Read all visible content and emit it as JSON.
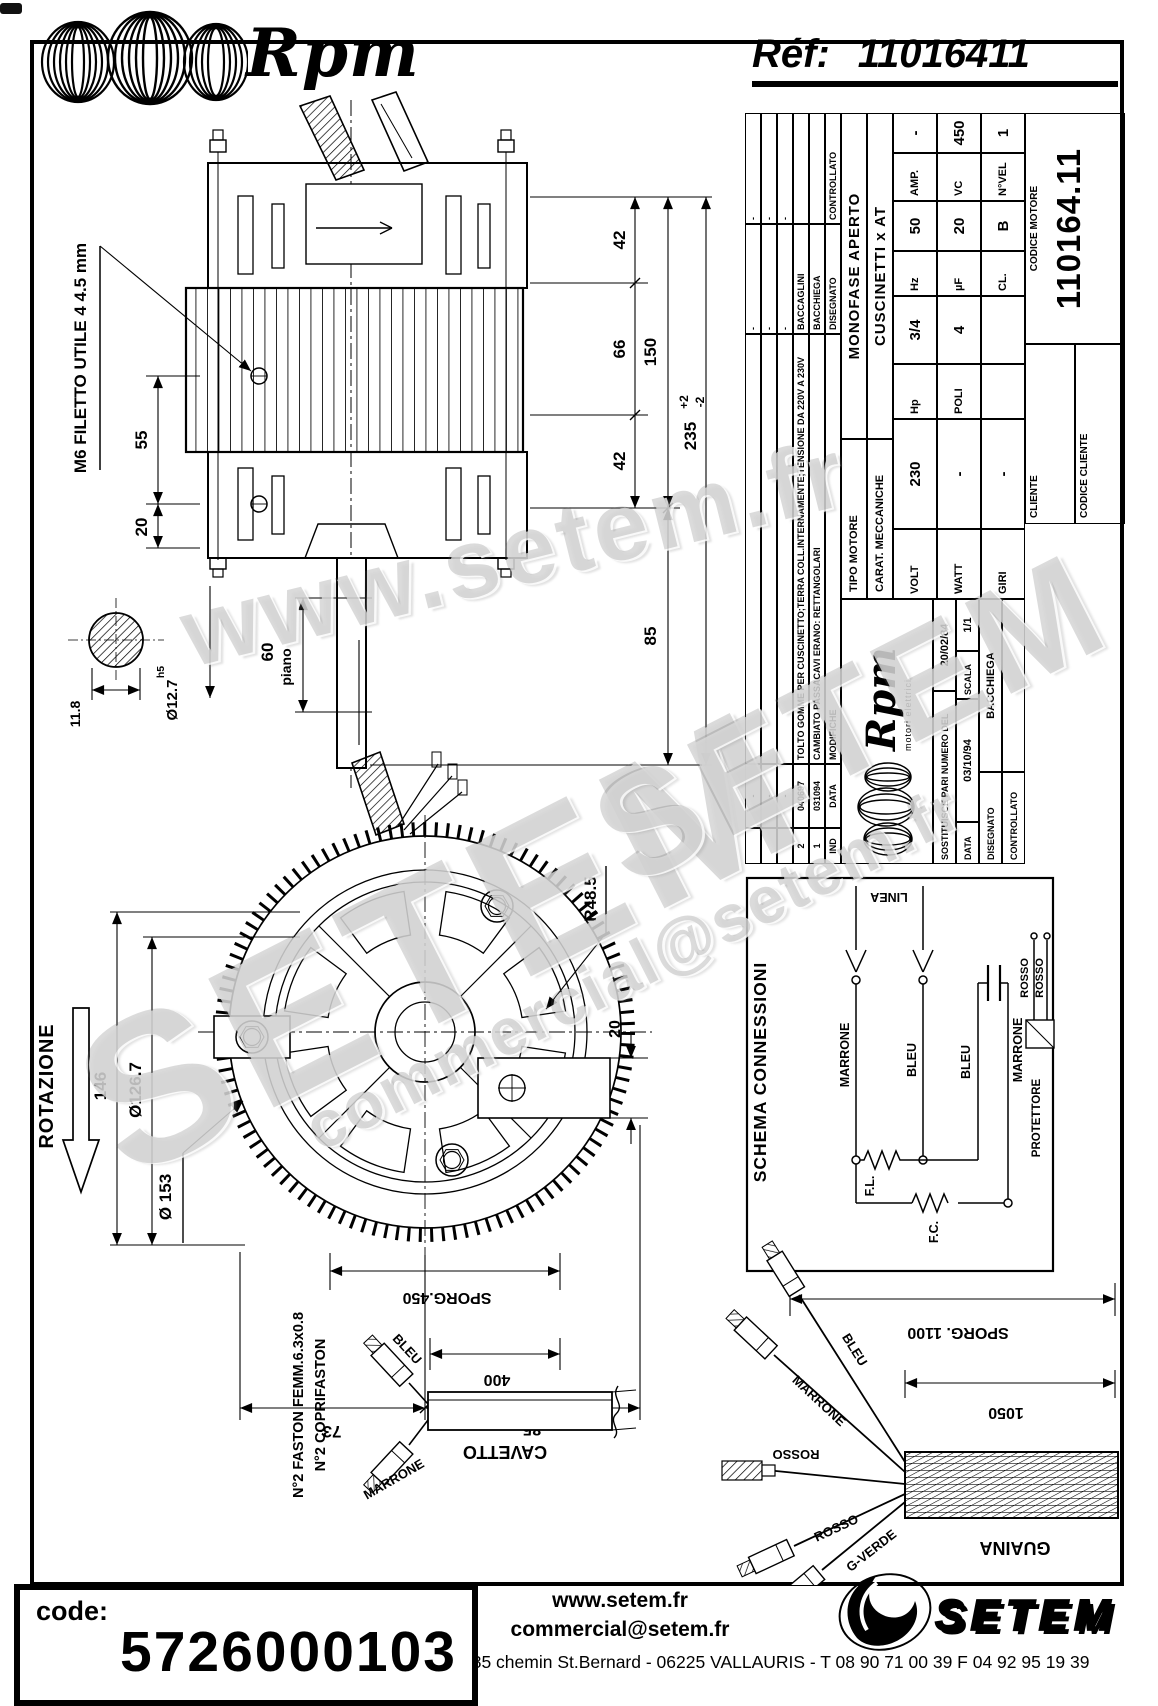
{
  "header": {
    "brand": "Rpm",
    "ref_label": "Réf:",
    "ref_value": "11016411"
  },
  "watermarks": {
    "w1": "www.setem.fr",
    "w2": "SETEM",
    "w3": "SETEM",
    "w4": "commercial@setem.fr"
  },
  "side_view": {
    "callout_m6": "M6 FILETTO UTILE 4  4.5 mm",
    "dim_55": "55",
    "dim_20": "20",
    "dim_42_top": "42",
    "dim_66": "66",
    "dim_42_bot": "42",
    "dim_150": "150",
    "dim_235": "235",
    "tol_plus": "+2",
    "tol_minus": "-2",
    "dim_85": "85",
    "dim_60": "60",
    "label_piano": "piano",
    "dim_11_8": "11.8",
    "dim_shaft": "Ø12.7",
    "fit_h5": "h5"
  },
  "front_view": {
    "label_rotazione": "ROTAZIONE",
    "dim_146": "146",
    "dim_126_7": "Ø126.7",
    "dim_153": "Ø 153",
    "dim_r48_5": "R48.5",
    "dim_20": "20",
    "dim_73": "73",
    "dim_85": "85"
  },
  "title_block": {
    "revisions": {
      "header": {
        "ind": "IND",
        "data": "DATA",
        "modifiche": "MODIFICHE",
        "disegnato": "DISEGNATO",
        "controllato": "CONTROLLATO"
      },
      "rows": [
        {
          "ind": "",
          "data": "-",
          "modifiche": "",
          "disegnato": "-",
          "controllato": "-"
        },
        {
          "ind": "",
          "data": "-",
          "modifiche": "",
          "disegnato": "-",
          "controllato": "-"
        },
        {
          "ind": "",
          "data": "-",
          "modifiche": "",
          "disegnato": "-",
          "controllato": "-"
        },
        {
          "ind": "2",
          "data": "040697",
          "modifiche": "TOLTO GOMME PER CUSCINETTO;TERRA COLL.INTERNAMENTE;TENSIONE DA 220V A 230V",
          "disegnato": "BACCAGLINI",
          "controllato": ""
        },
        {
          "ind": "1",
          "data": "031094",
          "modifiche": "CAMBIATO PASSACAVI ERANO: RETTANGOLARI",
          "disegnato": "BACCHIEGA",
          "controllato": ""
        }
      ]
    },
    "logo": {
      "brand": "Rpm",
      "tagline": "motori elettrici"
    },
    "sostituisce_label": "SOSTITUISCE PARI NUMERO DEL",
    "sostituisce_value": "20/02/84",
    "data_label": "DATA",
    "data_value": "03/10/94",
    "scala_label": "SCALA",
    "scala_value": "1/1",
    "disegnato_label": "DISEGNATO",
    "disegnato_value": "BACCHIEGA",
    "controllato_label": "CONTROLLATO",
    "controllato_value": "",
    "tipo_label": "TIPO MOTORE",
    "tipo_value": "MONOFASE APERTO",
    "carat_label": "CARAT. MECCANICHE",
    "carat_value": "CUSCINETTI x AT",
    "specs": [
      {
        "l1": "VOLT",
        "v1": "230",
        "l2": "Hp",
        "v2": "3/4",
        "l3": "Hz",
        "v3": "50",
        "l4": "AMP.",
        "v4": "-"
      },
      {
        "l1": "WATT",
        "v1": "-",
        "l2": "POLI",
        "v2": "4",
        "l3": "µF",
        "v3": "20",
        "l4": "VC",
        "v4": "450"
      },
      {
        "l1": "GIRI",
        "v1": "-",
        "l2": "",
        "v2": "",
        "l3": "CL.",
        "v3": "B",
        "l4": "N°VEL",
        "v4": "1"
      }
    ],
    "cliente_label": "CLIENTE",
    "codice_cliente_label": "CODICE CLIENTE",
    "codice_motore_label": "CODICE MOTORE",
    "codice_motore_value": "110164.11"
  },
  "schema": {
    "title": "SCHEMA CONNESSIONI",
    "linea": "LINEA",
    "wire_marrone_1": "MARRONE",
    "wire_bleu_1": "BLEU",
    "wire_bleu_2": "BLEU",
    "wire_marrone_2": "MARRONE",
    "fl": "F.L.",
    "fc": "F.C.",
    "rosso_1": "ROSSO",
    "rosso_2": "ROSSO",
    "protettore": "PROTETTORE"
  },
  "cavetto": {
    "sporg": "SPORG.450",
    "len": "400",
    "label": "CAVETTO",
    "wire_bleu": "BLEU",
    "wire_marrone": "MARRONE",
    "note1": "N°2 FASTON FEMM.6.3x0.8",
    "note2": "N°2 COPRIFASTON"
  },
  "guaina": {
    "sporg": "SPORG. 1100",
    "len": "1050",
    "label": "GUAINA",
    "wire_bleu": "BLEU",
    "wire_marrone": "MARRONE",
    "wire_rosso_1": "ROSSO",
    "wire_rosso_2": "ROSSO",
    "wire_gverde": "G-VERDE"
  },
  "footer": {
    "code_label": "code:",
    "code_value": "5726000103",
    "website": "www.setem.fr",
    "email": "commercial@setem.fr",
    "address": "885 chemin St.Bernard  -  06225 VALLAURIS  -  T 08 90 71 00 39   F 04 92 95 19 39",
    "brand": "SETEM"
  }
}
